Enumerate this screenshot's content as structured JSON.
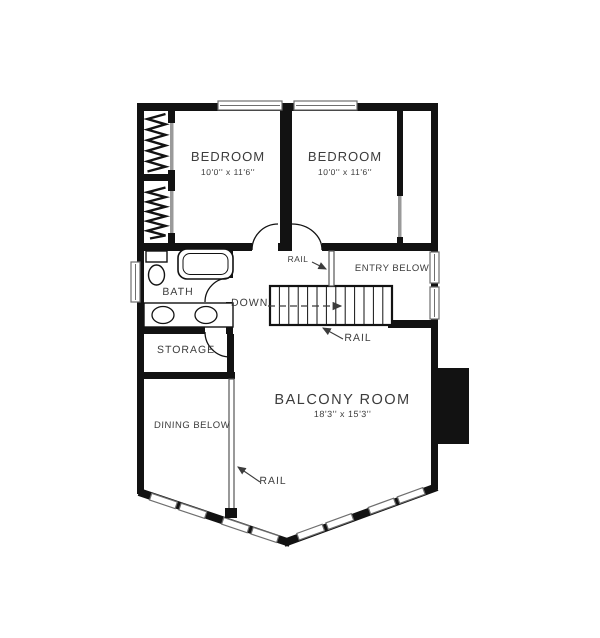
{
  "plan": {
    "rooms": {
      "bedroom_left": {
        "name": "BEDROOM",
        "dims": "10'0'' x 11'6''"
      },
      "bedroom_right": {
        "name": "BEDROOM",
        "dims": "10'0'' x 11'6''"
      },
      "bath": {
        "name": "BATH"
      },
      "storage": {
        "name": "STORAGE"
      },
      "entry_below": {
        "name": "ENTRY BELOW"
      },
      "dining_below": {
        "name": "DINING BELOW"
      },
      "balcony_room": {
        "name": "BALCONY ROOM",
        "dims": "18'3'' x 15'3''"
      }
    },
    "annotations": {
      "down": "DOWN",
      "rail_hall": "RAIL",
      "rail_stairs": "RAIL",
      "rail_dining": "RAIL"
    },
    "colors": {
      "wall": "#121212",
      "window": "#6e6e6e",
      "door": "#9a9a9a",
      "text": "#3c3c3c"
    }
  }
}
